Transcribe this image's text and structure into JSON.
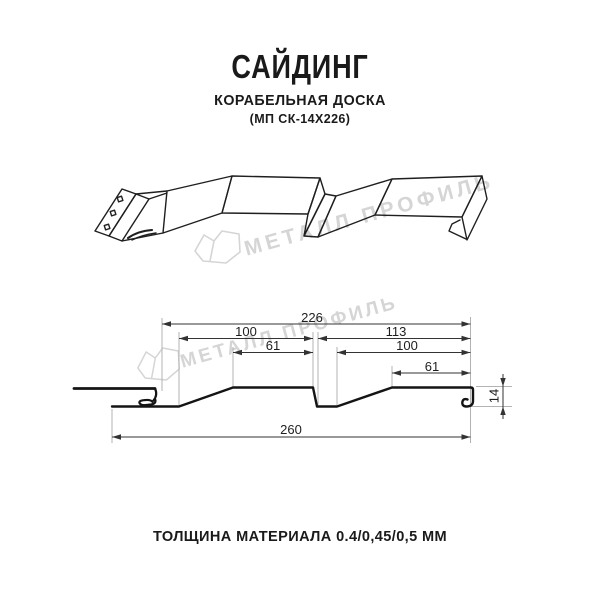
{
  "header": {
    "title": "САЙДИНГ",
    "subtitle": "КОРАБЕЛЬНАЯ ДОСКА",
    "model": "(МП СК-14Х226)"
  },
  "watermark": {
    "text": "МЕТАЛЛ ПРОФИЛЬ",
    "logo": "metal-profile-logo",
    "color": "#d5d5d5"
  },
  "drawing": {
    "product": "Сайдинг Корабельная доска МП СК-14Х226",
    "views": [
      "perspective-panel",
      "cross-section-with-dimensions"
    ]
  },
  "dimensions": {
    "overall_top": "226",
    "left_module_width": "100",
    "left_module_flat": "61",
    "right_module_span": "113",
    "right_module_width": "100",
    "right_module_flat": "61",
    "overall_bottom": "260",
    "profile_height": "14"
  },
  "footer": {
    "thickness_label": "ТОЛЩИНА МАТЕРИАЛА 0.4/0,45/0,5 ММ"
  },
  "colors": {
    "line": "#141414",
    "dimension_line": "#333333",
    "extension_line": "#b3b3b3",
    "watermark": "#d5d5d5",
    "background": "#ffffff"
  }
}
